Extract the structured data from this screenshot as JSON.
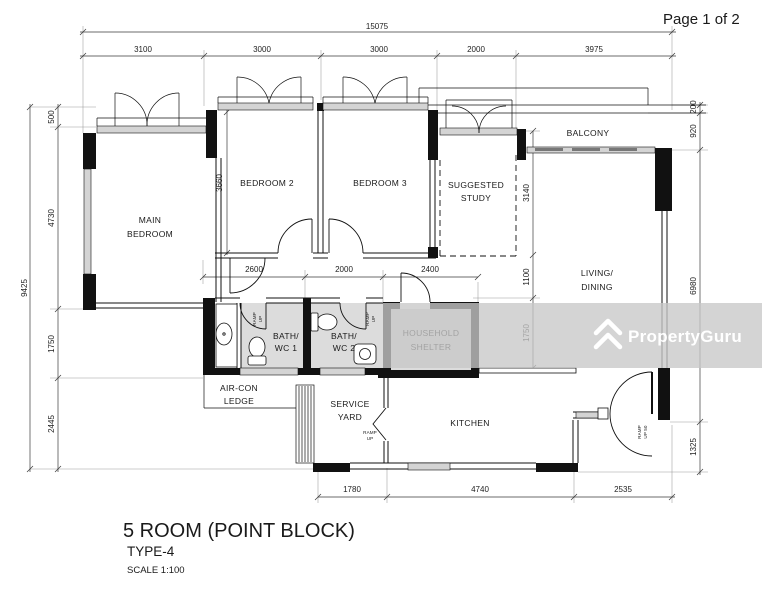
{
  "page": {
    "indicator": "Page 1 of 2"
  },
  "watermark": {
    "brand": "PropertyGuru"
  },
  "titleBlock": {
    "title": "5 ROOM (POINT BLOCK)",
    "type": "TYPE-4",
    "scale": "SCALE 1:100"
  },
  "rooms": {
    "mainBedroom1": "MAIN",
    "mainBedroom2": "BEDROOM",
    "bedroom2": "BEDROOM 2",
    "bedroom3": "BEDROOM 3",
    "study1": "SUGGESTED",
    "study2": "STUDY",
    "balcony": "BALCONY",
    "living1": "LIVING/",
    "living2": "DINING",
    "bath1a": "BATH/",
    "bath1b": "WC 1",
    "bath2a": "BATH/",
    "bath2b": "WC 2",
    "shelter1": "HOUSEHOLD",
    "shelter2": "SHELTER",
    "aircon1": "AIR-CON",
    "aircon2": "LEDGE",
    "service1": "SERVICE",
    "service2": "YARD",
    "kitchen": "KITCHEN",
    "rampA": "RAMP",
    "rampB": "UP",
    "ramp50B": "UP 50"
  },
  "dims": {
    "total": "15075",
    "top": [
      "3100",
      "3000",
      "3000",
      "2000",
      "3975"
    ],
    "leftTotal": "9425",
    "left": [
      "500",
      "4730",
      "1750",
      "2445"
    ],
    "right": [
      "200",
      "920",
      "6980",
      "1325"
    ],
    "inner": {
      "bed2h": "3660",
      "studyh": "3140",
      "foyerh": "1100",
      "shelterh": "1750",
      "hall": [
        "2600",
        "2000",
        "2400"
      ]
    },
    "bottom": [
      "1780",
      "4740",
      "2535"
    ]
  }
}
